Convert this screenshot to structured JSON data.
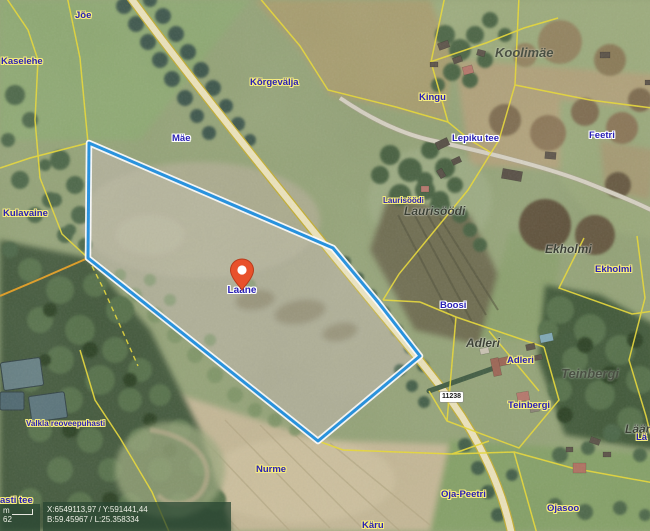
{
  "labels": [
    "Jõe",
    "Kaselehe",
    "Kõrgevälja",
    "Kingu",
    "Koolimäe",
    "Feetri",
    "Lepiku tee",
    "Mäe",
    "Laurisöödi",
    "Laurisöödi",
    "Ekholmi",
    "Ekholmi",
    "Kulavaine",
    "Boosi",
    "Adleri",
    "Adleri",
    "Teinbergi",
    "Teinbergi",
    "Nurme",
    "Oja-Peetri",
    "Ojasoo",
    "Käru",
    "Valkla reoveepuhasti",
    "asti tee",
    "Lään",
    "Lä"
  ],
  "marker": {
    "label": "Laane",
    "color": "#e8512b"
  },
  "road_badge": "11238",
  "status": {
    "xy": "X:6549113,97 / Y:591441,44",
    "bl": "B:59.45967 / L:25.358334",
    "scale_unit": "m",
    "scale_value": "62"
  },
  "colors": {
    "parcel_outline": "#1d8fe0",
    "parcel_casing": "#ffffff",
    "cadastral_line": "#e8d935",
    "orange_line": "#e09b1f",
    "road_fill": "#ece3bb",
    "label_blue": "#2a21b5",
    "label_halo_yellow": "#f6ec7e"
  }
}
